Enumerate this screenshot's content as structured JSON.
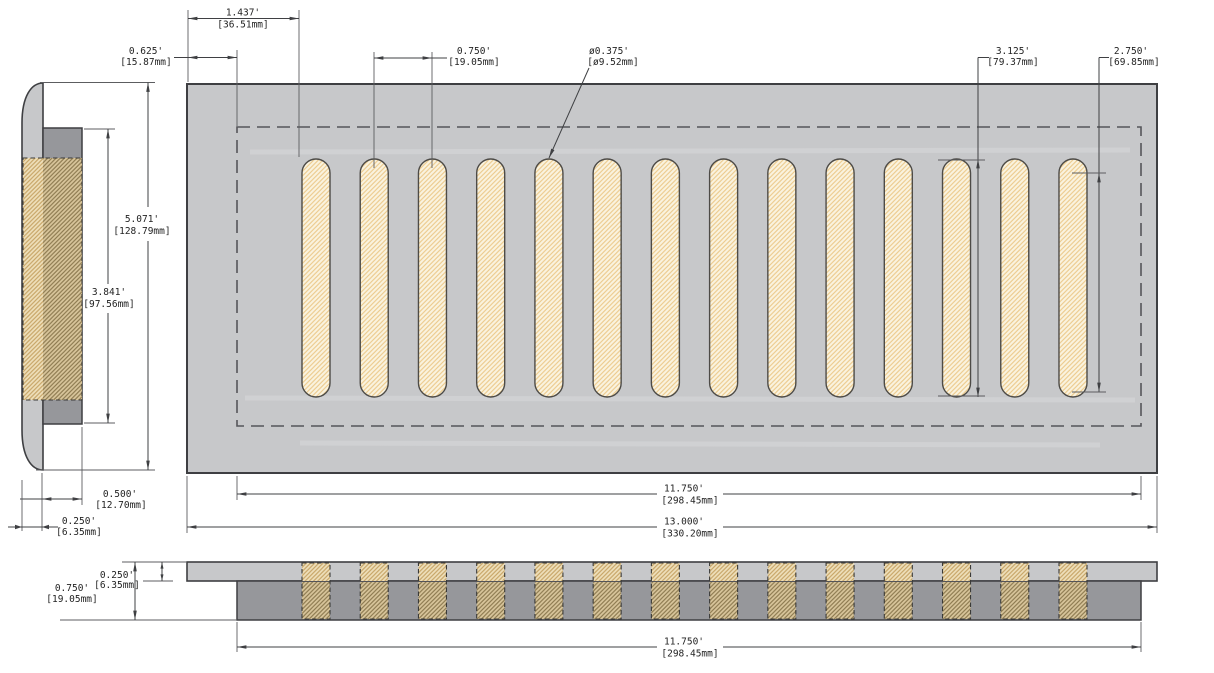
{
  "drawing": {
    "type": "technical-drawing",
    "subject": "vent-register-three-view",
    "slot_count": 14,
    "dims": {
      "slot_offset": {
        "in": "1.437'",
        "mm": "[36.51mm]"
      },
      "inset_offset": {
        "in": "0.625'",
        "mm": "[15.87mm]"
      },
      "slot_spacing": {
        "in": "0.750'",
        "mm": "[19.05mm]"
      },
      "slot_width": {
        "in": "ø0.375'",
        "mm": "[ø9.52mm]"
      },
      "slot_length": {
        "in": "3.125'",
        "mm": "[79.37mm]"
      },
      "slot_straight": {
        "in": "2.750'",
        "mm": "[69.85mm]"
      },
      "overall_height": {
        "in": "5.071'",
        "mm": "[128.79mm]"
      },
      "opening_height": {
        "in": "3.841'",
        "mm": "[97.56mm]"
      },
      "duct_depth": {
        "in": "0.500'",
        "mm": "[12.70mm]"
      },
      "flange_depth": {
        "in": "0.250'",
        "mm": "[6.35mm]"
      },
      "opening_width": {
        "in": "11.750'",
        "mm": "[298.45mm]"
      },
      "overall_width": {
        "in": "13.000'",
        "mm": "[330.20mm]"
      },
      "front_height": {
        "in": "0.750'",
        "mm": "[19.05mm]"
      },
      "front_plate_thick": {
        "in": "0.250'",
        "mm": "[6.35mm]"
      },
      "front_opening": {
        "in": "11.750'",
        "mm": "[298.45mm]"
      }
    },
    "colors": {
      "plate_gray": "#c7c8ca",
      "duct_gray": "#96979b",
      "slot_cream": "#faf3df",
      "slot_hatch": "#ecca8c",
      "tan_light": "#eedfba",
      "tan_dark": "#d8c59b",
      "line_dark": "#3f4043"
    }
  }
}
